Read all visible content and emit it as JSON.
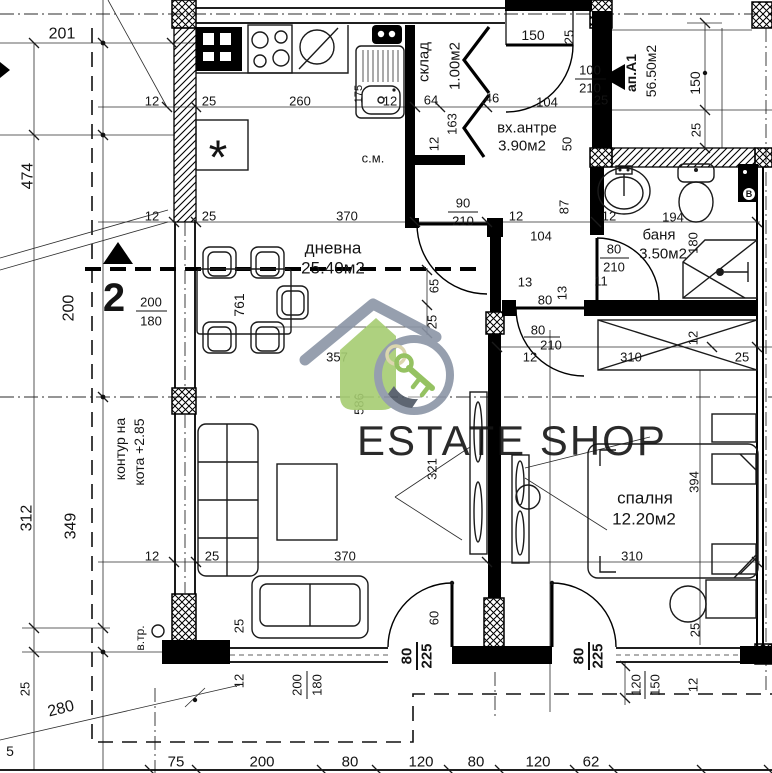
{
  "meta": {
    "drawing_type": "apartment floor plan",
    "language": "bg"
  },
  "watermark": {
    "text": "ESTATE SHOP",
    "text_color": "#8b95a6",
    "roof_color": "#8b95a6",
    "house_color": "#a6cd72",
    "ring_color": "#8b95a6",
    "key_color": "#8abc52",
    "keyring_color": "#d8d2a6",
    "accent_dark": "#4d5663"
  },
  "rooms": [
    {
      "label": "дневна",
      "area": "25.40м2"
    },
    {
      "label": "спалня",
      "area": "12.20м2"
    },
    {
      "label": "баня",
      "area": "3.50м2"
    },
    {
      "label": "вх.антре",
      "area": "3.90м2"
    },
    {
      "label": "склад",
      "area": "1.00м2"
    },
    {
      "label": "ап.А1",
      "area": "56.50м2"
    }
  ],
  "labels": [
    {
      "t": "201",
      "x": 62,
      "y": 34,
      "s": 16
    },
    {
      "t": "474",
      "x": 28,
      "y": 176,
      "r": -90,
      "s": 16
    },
    {
      "t": "200",
      "x": 69,
      "y": 308,
      "r": -90,
      "s": 16
    },
    {
      "t": "312",
      "x": 27,
      "y": 518,
      "r": -90,
      "s": 16
    },
    {
      "t": "349",
      "x": 71,
      "y": 526,
      "r": -90,
      "s": 16
    },
    {
      "t": "280",
      "x": 61,
      "y": 709,
      "r": -14,
      "s": 16
    },
    {
      "t": "25",
      "x": 25,
      "y": 689,
      "r": -90
    },
    {
      "t": "5",
      "x": 10,
      "y": 751,
      "s": 14
    },
    {
      "t": "2",
      "x": 114,
      "y": 298,
      "s": 40,
      "b": 1,
      "n": "section-marker-2"
    },
    {
      "t": "200",
      "x": 151,
      "y": 302
    },
    {
      "t": "180",
      "x": 151,
      "y": 321
    },
    {
      "t": "контур на",
      "x": 120,
      "y": 449,
      "r": -90,
      "s": 14,
      "n": "elevation-note"
    },
    {
      "t": "кота +2.85",
      "x": 139,
      "y": 452,
      "r": -90,
      "s": 14,
      "n": "elevation-note"
    },
    {
      "t": "в.тр.",
      "x": 140,
      "y": 638,
      "r": -90,
      "s": 12,
      "n": "vent-pipe-label"
    },
    {
      "t": "12",
      "x": 152,
      "y": 101
    },
    {
      "t": "25",
      "x": 209,
      "y": 101
    },
    {
      "t": "260",
      "x": 300,
      "y": 101
    },
    {
      "t": "175",
      "x": 359,
      "y": 94,
      "r": -90,
      "s": 11
    },
    {
      "t": "12",
      "x": 390,
      "y": 101
    },
    {
      "t": "64",
      "x": 431,
      "y": 100
    },
    {
      "t": "46",
      "x": 492,
      "y": 98
    },
    {
      "t": "склад",
      "x": 424,
      "y": 62,
      "r": -90,
      "s": 15,
      "n": "room-label-storage"
    },
    {
      "t": "1.00м2",
      "x": 455,
      "y": 66,
      "r": -90,
      "s": 15,
      "n": "room-area-storage"
    },
    {
      "t": "163",
      "x": 452,
      "y": 124,
      "r": -90
    },
    {
      "t": "12",
      "x": 434,
      "y": 144,
      "r": -90
    },
    {
      "t": "150",
      "x": 533,
      "y": 35,
      "s": 14
    },
    {
      "t": "25",
      "x": 569,
      "y": 37,
      "r": -90
    },
    {
      "t": "104",
      "x": 547,
      "y": 102
    },
    {
      "t": "вх.антре",
      "x": 527,
      "y": 128,
      "s": 15,
      "n": "room-label-entry"
    },
    {
      "t": "3.90м2",
      "x": 522,
      "y": 146,
      "s": 15,
      "n": "room-area-entry"
    },
    {
      "t": "100",
      "x": 590,
      "y": 70
    },
    {
      "t": "210",
      "x": 590,
      "y": 88
    },
    {
      "t": "25",
      "x": 601,
      "y": 100
    },
    {
      "t": "ап.А1",
      "x": 631,
      "y": 73,
      "r": -90,
      "s": 14,
      "b": 1,
      "n": "apartment-label"
    },
    {
      "t": "56.50м2",
      "x": 651,
      "y": 71,
      "r": -90,
      "s": 14,
      "n": "apartment-area"
    },
    {
      "t": "150",
      "x": 695,
      "y": 83,
      "r": -90,
      "s": 14
    },
    {
      "t": "25",
      "x": 696,
      "y": 130,
      "r": -90
    },
    {
      "t": "с.м.",
      "x": 373,
      "y": 158,
      "s": 13,
      "n": "washing-machine-label"
    },
    {
      "t": "50",
      "x": 567,
      "y": 144,
      "r": -90
    },
    {
      "t": "90",
      "x": 463,
      "y": 203
    },
    {
      "t": "210",
      "x": 463,
      "y": 221
    },
    {
      "t": "12",
      "x": 516,
      "y": 216
    },
    {
      "t": "87",
      "x": 564,
      "y": 207,
      "r": -90
    },
    {
      "t": "12",
      "x": 609,
      "y": 216
    },
    {
      "t": "194",
      "x": 673,
      "y": 217
    },
    {
      "t": "104",
      "x": 541,
      "y": 236
    },
    {
      "t": "баня",
      "x": 659,
      "y": 235,
      "s": 15,
      "n": "room-label-bath"
    },
    {
      "t": "3.50м2",
      "x": 663,
      "y": 254,
      "s": 15,
      "n": "room-area-bath"
    },
    {
      "t": "180",
      "x": 693,
      "y": 243,
      "r": -90
    },
    {
      "t": "80",
      "x": 614,
      "y": 249
    },
    {
      "t": "210",
      "x": 614,
      "y": 267
    },
    {
      "t": "11",
      "x": 601,
      "y": 281
    },
    {
      "t": "13",
      "x": 525,
      "y": 282
    },
    {
      "t": "80",
      "x": 545,
      "y": 300
    },
    {
      "t": "13",
      "x": 562,
      "y": 293,
      "r": -90
    },
    {
      "t": "65",
      "x": 434,
      "y": 286,
      "r": -90
    },
    {
      "t": "25",
      "x": 432,
      "y": 322,
      "r": -90
    },
    {
      "t": "80",
      "x": 538,
      "y": 330
    },
    {
      "t": "210",
      "x": 551,
      "y": 345
    },
    {
      "t": "12",
      "x": 530,
      "y": 357
    },
    {
      "t": "310",
      "x": 631,
      "y": 357
    },
    {
      "t": "25",
      "x": 742,
      "y": 357
    },
    {
      "t": "12",
      "x": 693,
      "y": 338,
      "r": -90
    },
    {
      "t": "12",
      "x": 152,
      "y": 216
    },
    {
      "t": "25",
      "x": 209,
      "y": 216
    },
    {
      "t": "370",
      "x": 347,
      "y": 216
    },
    {
      "t": "дневна",
      "x": 333,
      "y": 248,
      "s": 17,
      "n": "room-label-living"
    },
    {
      "t": "25.40м2",
      "x": 333,
      "y": 268,
      "s": 17,
      "n": "room-area-living"
    },
    {
      "t": "761",
      "x": 239,
      "y": 305,
      "r": -90,
      "s": 14
    },
    {
      "t": "357",
      "x": 337,
      "y": 357
    },
    {
      "t": "586",
      "x": 359,
      "y": 404,
      "r": -90
    },
    {
      "t": "321",
      "x": 432,
      "y": 469,
      "r": -90
    },
    {
      "t": "спалня",
      "x": 645,
      "y": 498,
      "s": 17,
      "n": "room-label-bedroom"
    },
    {
      "t": "12.20м2",
      "x": 644,
      "y": 519,
      "s": 17,
      "n": "room-area-bedroom"
    },
    {
      "t": "394",
      "x": 694,
      "y": 482,
      "r": -90
    },
    {
      "t": "310",
      "x": 632,
      "y": 556
    },
    {
      "t": "25",
      "x": 695,
      "y": 630,
      "r": -90
    },
    {
      "t": "12",
      "x": 152,
      "y": 556
    },
    {
      "t": "25",
      "x": 212,
      "y": 556
    },
    {
      "t": "370",
      "x": 345,
      "y": 556
    },
    {
      "t": "25",
      "x": 239,
      "y": 626,
      "r": -90
    },
    {
      "t": "12",
      "x": 239,
      "y": 681,
      "r": -90
    },
    {
      "t": "200",
      "x": 297,
      "y": 685,
      "r": -90
    },
    {
      "t": "180",
      "x": 317,
      "y": 685,
      "r": -90
    },
    {
      "t": "80",
      "x": 407,
      "y": 656,
      "r": -90,
      "b": 1,
      "s": 15
    },
    {
      "t": "225",
      "x": 427,
      "y": 656,
      "r": -90,
      "b": 1,
      "s": 15
    },
    {
      "t": "60",
      "x": 434,
      "y": 618,
      "r": -90
    },
    {
      "t": "80",
      "x": 579,
      "y": 656,
      "r": -90,
      "b": 1,
      "s": 15
    },
    {
      "t": "225",
      "x": 598,
      "y": 656,
      "r": -90,
      "b": 1,
      "s": 15
    },
    {
      "t": "120",
      "x": 636,
      "y": 685,
      "r": -90
    },
    {
      "t": "150",
      "x": 655,
      "y": 685,
      "r": -90
    },
    {
      "t": "12",
      "x": 693,
      "y": 685,
      "r": -90
    },
    {
      "t": "75",
      "x": 176,
      "y": 762,
      "s": 15
    },
    {
      "t": "200",
      "x": 262,
      "y": 762,
      "s": 15
    },
    {
      "t": "80",
      "x": 350,
      "y": 762,
      "s": 15
    },
    {
      "t": "120",
      "x": 421,
      "y": 762,
      "s": 15
    },
    {
      "t": "80",
      "x": 476,
      "y": 762,
      "s": 15
    },
    {
      "t": "120",
      "x": 538,
      "y": 762,
      "s": 15
    },
    {
      "t": "62",
      "x": 591,
      "y": 762,
      "s": 15
    },
    {
      "t": "B",
      "x": 749,
      "y": 194,
      "s": 9,
      "b": 1,
      "n": "boiler-label"
    },
    {
      "t": "*",
      "x": 218,
      "y": 158,
      "s": 48,
      "n": "fridge-symbol"
    }
  ]
}
